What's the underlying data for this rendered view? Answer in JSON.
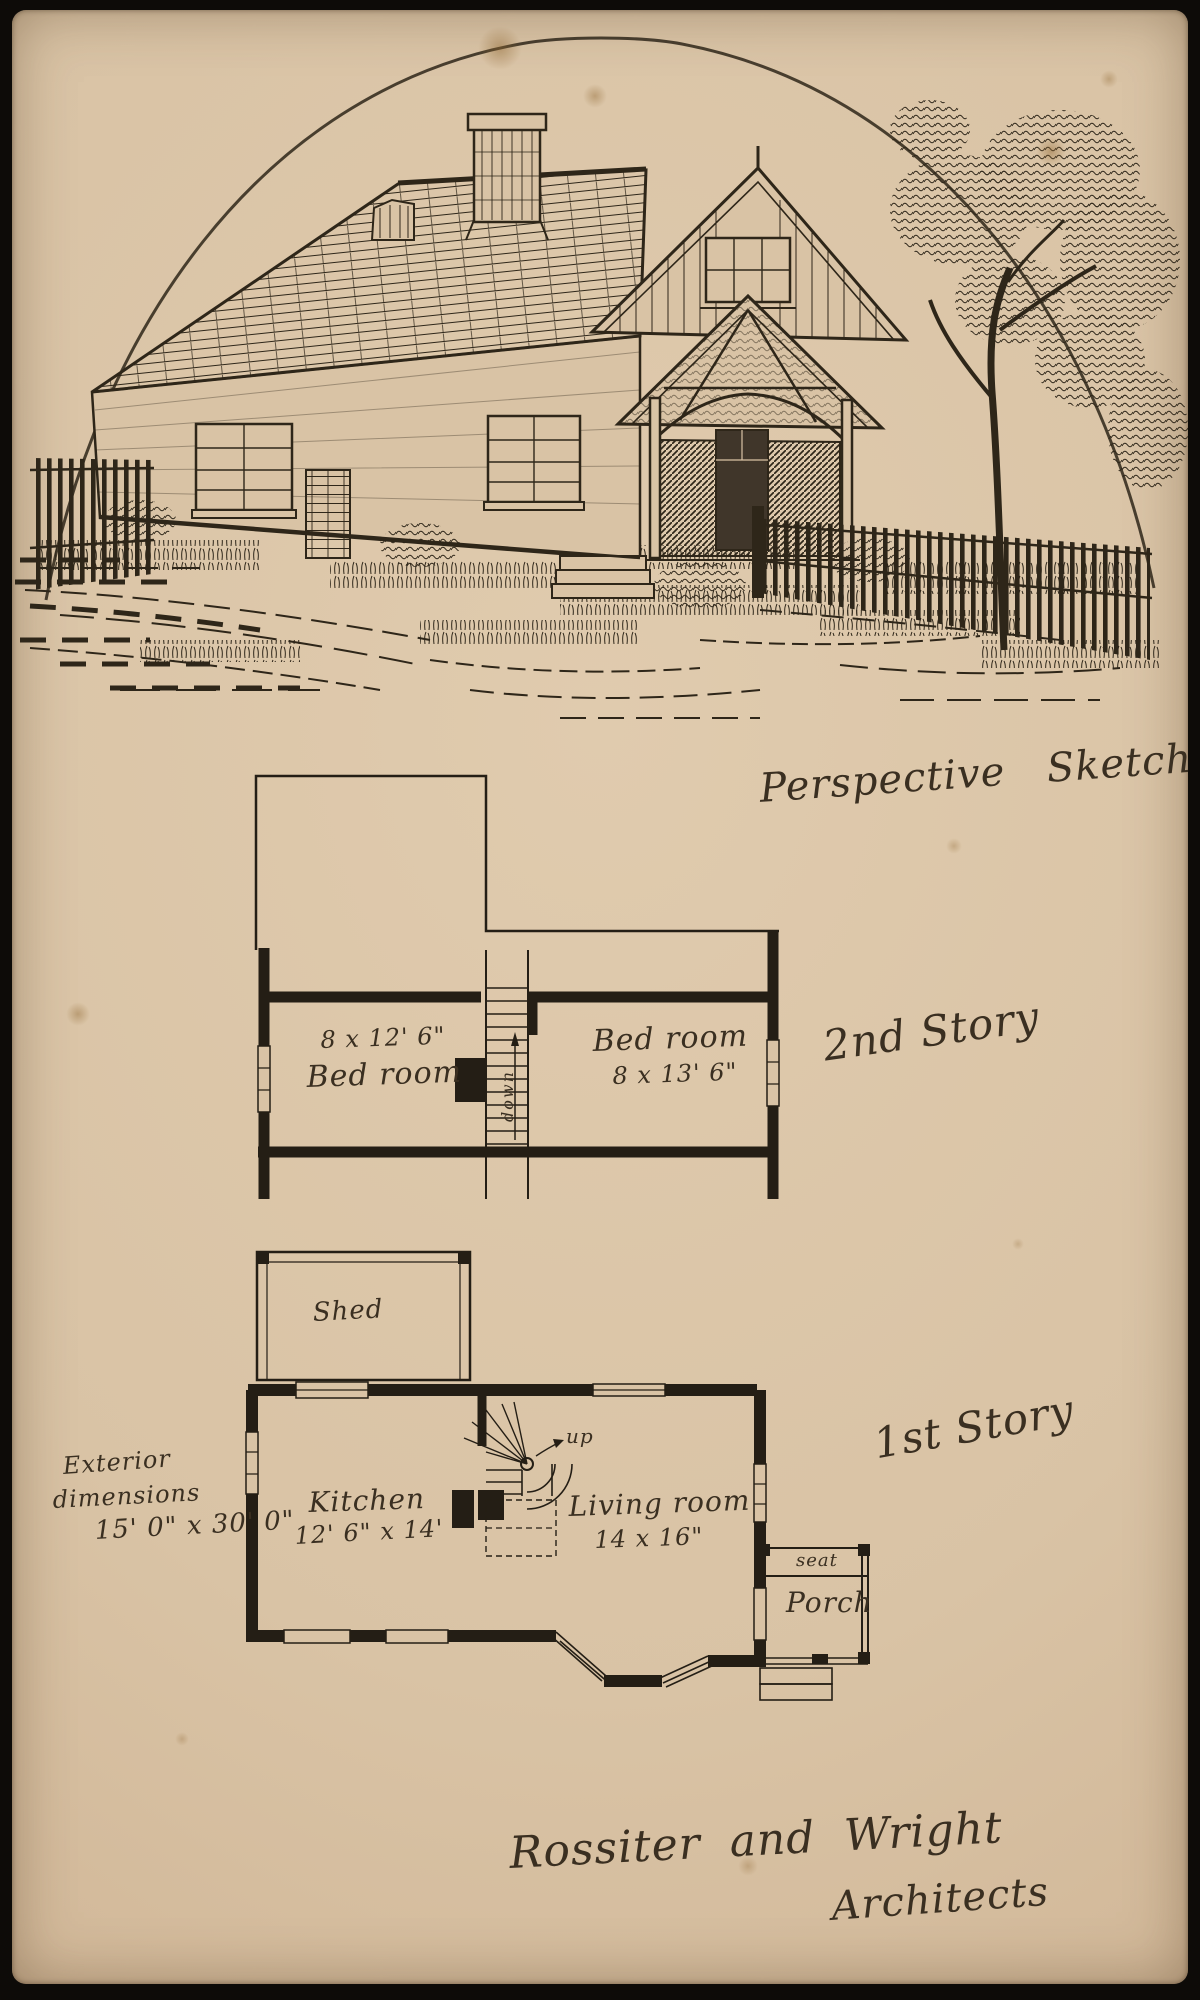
{
  "sketch": {
    "caption": "Perspective Sketch"
  },
  "second_story": {
    "label": "2nd Story",
    "bedroom_left": {
      "dims": "8 x 12' 6\"",
      "name": "Bed room"
    },
    "bedroom_right": {
      "name": "Bed room",
      "dims": "8 x 13' 6\""
    },
    "stair_label": "down"
  },
  "first_story": {
    "label": "1st Story",
    "shed_label": "Shed",
    "kitchen": {
      "name": "Kitchen",
      "dims": "12' 6\" x 14'"
    },
    "living_room": {
      "name": "Living room",
      "dims": "14 x 16\""
    },
    "stair_label": "up",
    "porch": {
      "seat_label": "seat",
      "name": "Porch"
    },
    "exterior_note": {
      "line1": "Exterior",
      "line2": "dimensions",
      "line3": "15' 0\" x 30' 0\""
    }
  },
  "footer": {
    "firm": "Rossiter and Wright",
    "role": "Architects"
  },
  "colors": {
    "paper": "#d9c3a5",
    "ink": "#2e2619"
  }
}
